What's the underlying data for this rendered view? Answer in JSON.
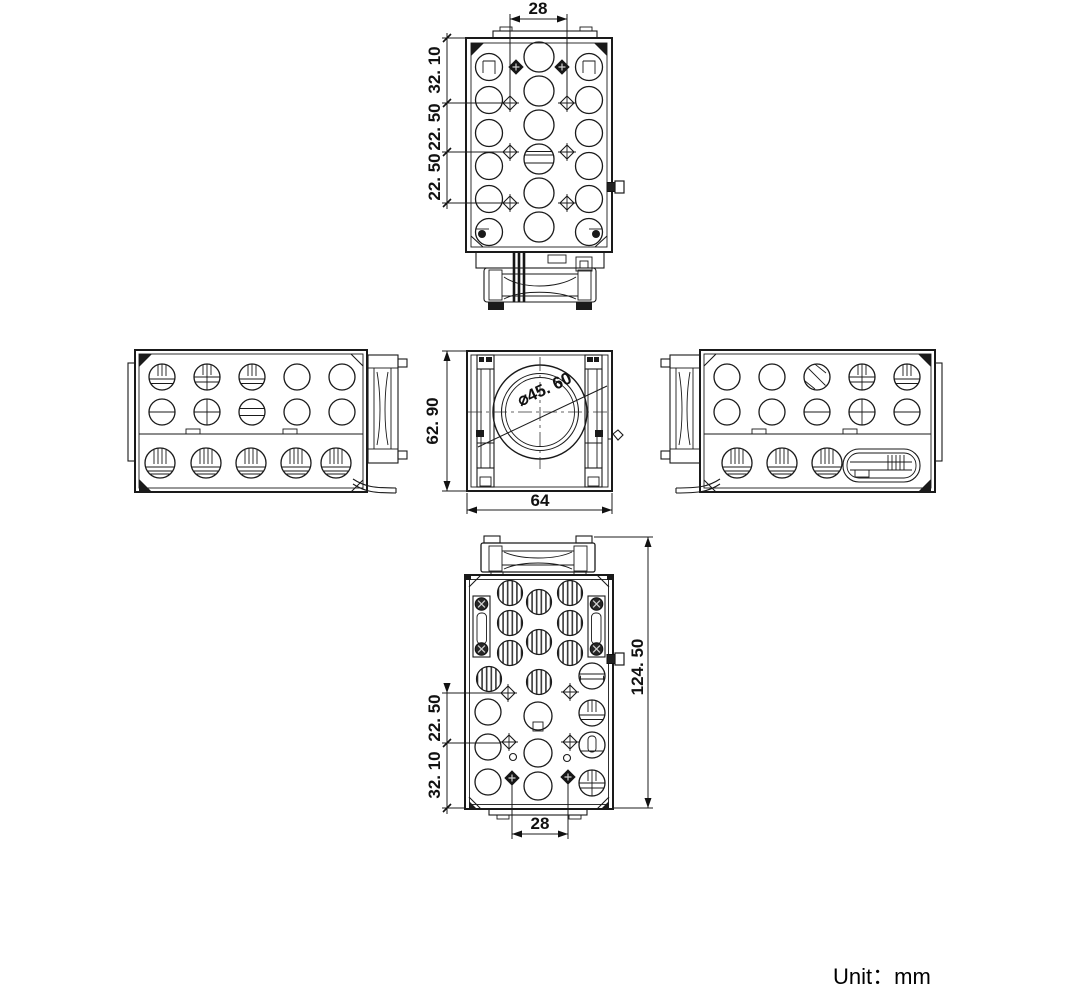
{
  "unit_label": "Unit：mm",
  "dimensions": {
    "top_view": {
      "screw_span": "28",
      "seg1": "32. 10",
      "seg2": "22. 50",
      "seg3": "22. 50"
    },
    "front_view": {
      "height": "62. 90",
      "width": "64",
      "lens_diameter": "⌀45. 60"
    },
    "bottom_view": {
      "total_length": "124. 50",
      "seg1": "22. 50",
      "seg2": "32. 10",
      "screw_span": "28"
    }
  }
}
